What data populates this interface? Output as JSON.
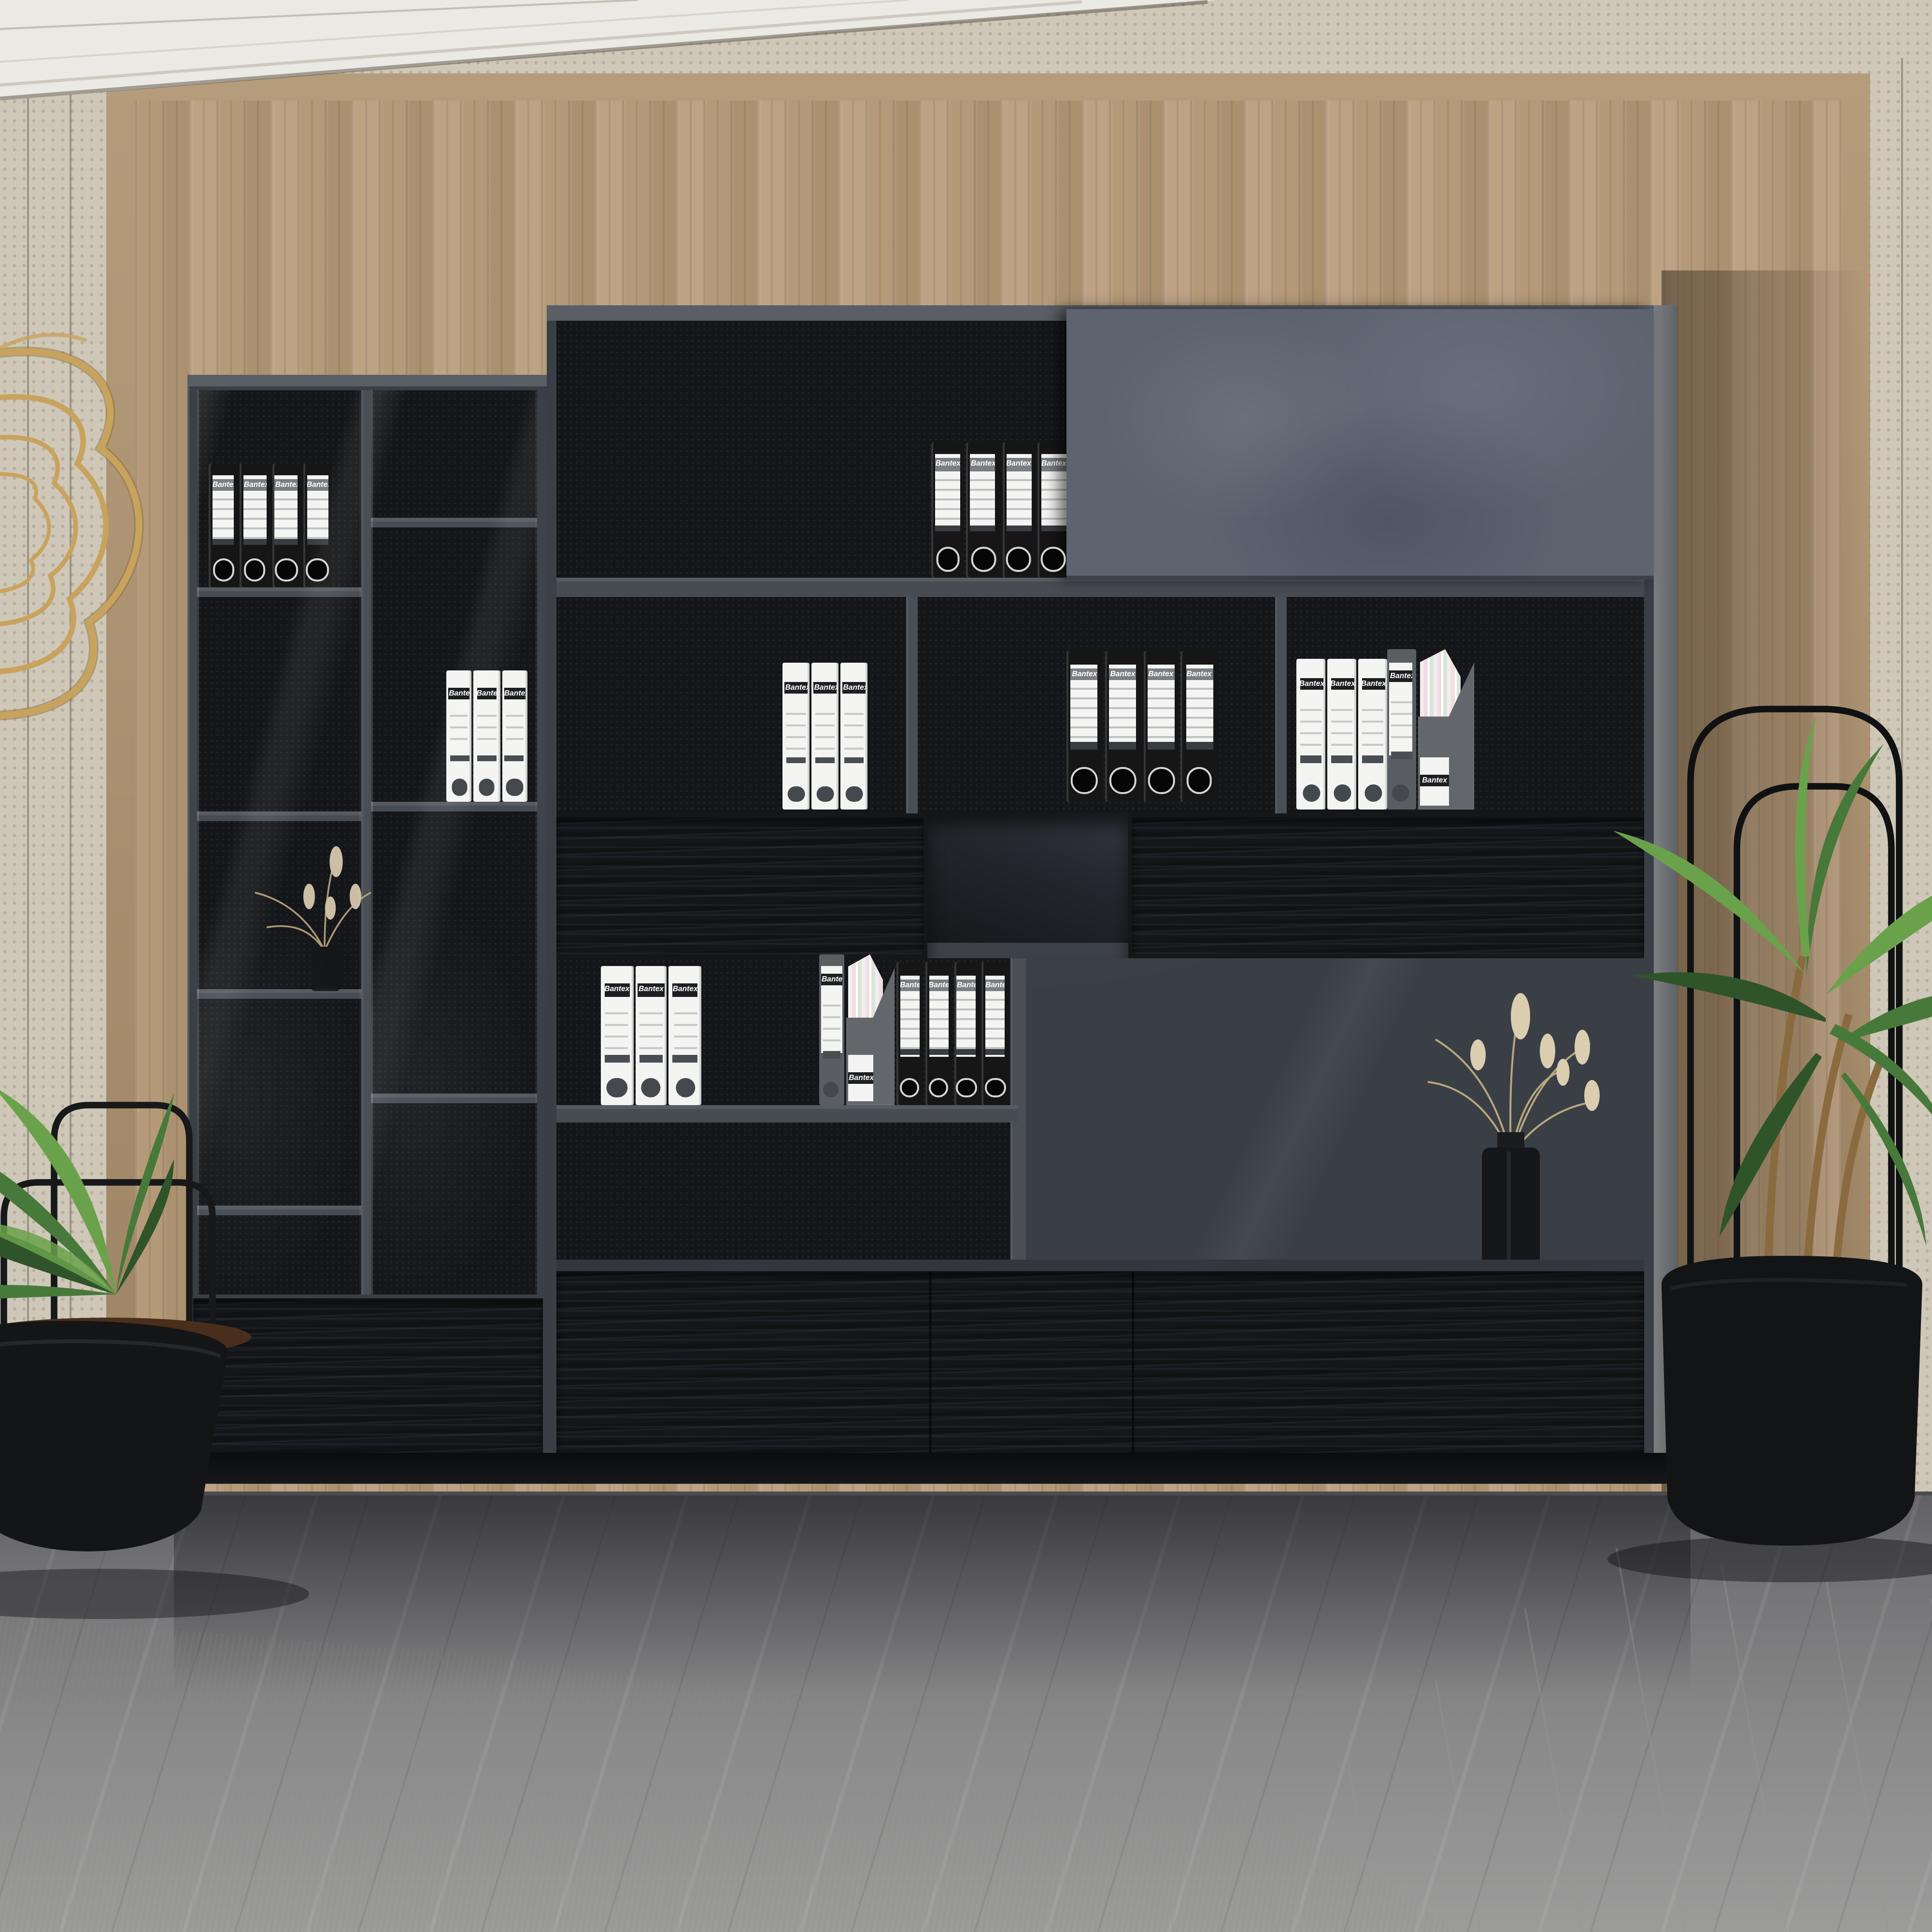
{
  "brand_label": "Bantex",
  "scene": {
    "description": "Modern office lounge: large dark-gray modular bookshelf and filing wall unit with glass-door cabinet, closed sliding-door top cabinet, open shelves of lever-arch binders, black wood-grain drawers; wood slat panel wall with crown molding and beige fabric panels, gold wire wall sculpture, two potted palm plants in black planters, black vases with dried flowers, gray marble floor, white marble band and a light area rug.",
    "objects": [
      "bookshelf-wall-unit",
      "glass-door-cabinet",
      "sliding-door-cabinet",
      "lever-arch-binders",
      "magazine-files",
      "dried-flower-vases",
      "potted-palm-left",
      "potted-palm-right",
      "gold-wire-wall-sculpture",
      "wood-panel-wall",
      "fabric-wall-panels",
      "crown-molding",
      "marble-floor",
      "white-marble-band",
      "area-rug"
    ]
  },
  "cabinet": {
    "left_glass_cabinet": {
      "doors": 2,
      "contents": [
        "black-binders-4",
        "white-binders-3",
        "dried-flower-vase"
      ],
      "base": "drawer"
    },
    "main_section": {
      "sliding_door": "closed",
      "top_shelf_binders": 4,
      "middle_compartments": 3,
      "drawer_rows": 2,
      "large_open_bay_contents": [
        "dried-flower-vase"
      ]
    }
  },
  "binder_groups": [
    {
      "id": "left-col1-black",
      "items": [
        "black",
        "black",
        "black",
        "black"
      ]
    },
    {
      "id": "left-col2-white",
      "items": [
        "white",
        "white",
        "white"
      ]
    },
    {
      "id": "main-top-black",
      "items": [
        "black",
        "black",
        "black",
        "black"
      ]
    },
    {
      "id": "row2-white",
      "items": [
        "white",
        "white",
        "white"
      ]
    },
    {
      "id": "row2-black",
      "items": [
        "black",
        "black",
        "black",
        "black"
      ]
    },
    {
      "id": "row2-right-white",
      "items": [
        "white",
        "white",
        "white"
      ]
    },
    {
      "id": "row2-right-mixed",
      "items": [
        "gray",
        "magfile"
      ]
    },
    {
      "id": "row4-white",
      "items": [
        "white",
        "white",
        "white"
      ]
    },
    {
      "id": "row4-mixed",
      "items": [
        "gray",
        "magfile"
      ]
    },
    {
      "id": "row4-black",
      "items": [
        "black",
        "black",
        "black",
        "black"
      ]
    }
  ],
  "palette": {
    "wall_fabric": "#cfc8b9",
    "crown_white": "#ebe9e4",
    "wood": "#b49a78",
    "wood_frame": "#a78e6c",
    "cabinet": "#3a3f46",
    "cabinet_top": "#5a5f66",
    "cabinet_interior": "#141619",
    "divider": "#4a4f56",
    "side_panel": "#74777a",
    "door_gray": "#5d6470",
    "drawer_black": "#15171a",
    "shelf_board": "#474c53",
    "floor_marble": "#78787a",
    "white_marble": "#d9d8d4",
    "rug": "#e3e0da",
    "gold": "#c8a35e",
    "plant_green": "#47793a",
    "plant_green_dark": "#2f5429",
    "plant_green_light": "#6aa24c",
    "trunk_brown": "#8a6a3f",
    "soil_brown": "#4a2e1c",
    "mulch_brown": "#5b3a22",
    "vase_black": "#16171a",
    "dried_beige": "#b9a77e",
    "dried_plume": "#dbcdb0",
    "binder_black": "#161616",
    "binder_white": "#f4f4f2",
    "binder_gray": "#5a5e62",
    "magfile_gray": "#63676b",
    "paper_pink": "#f0dde2",
    "paper_green": "#dce4da"
  }
}
